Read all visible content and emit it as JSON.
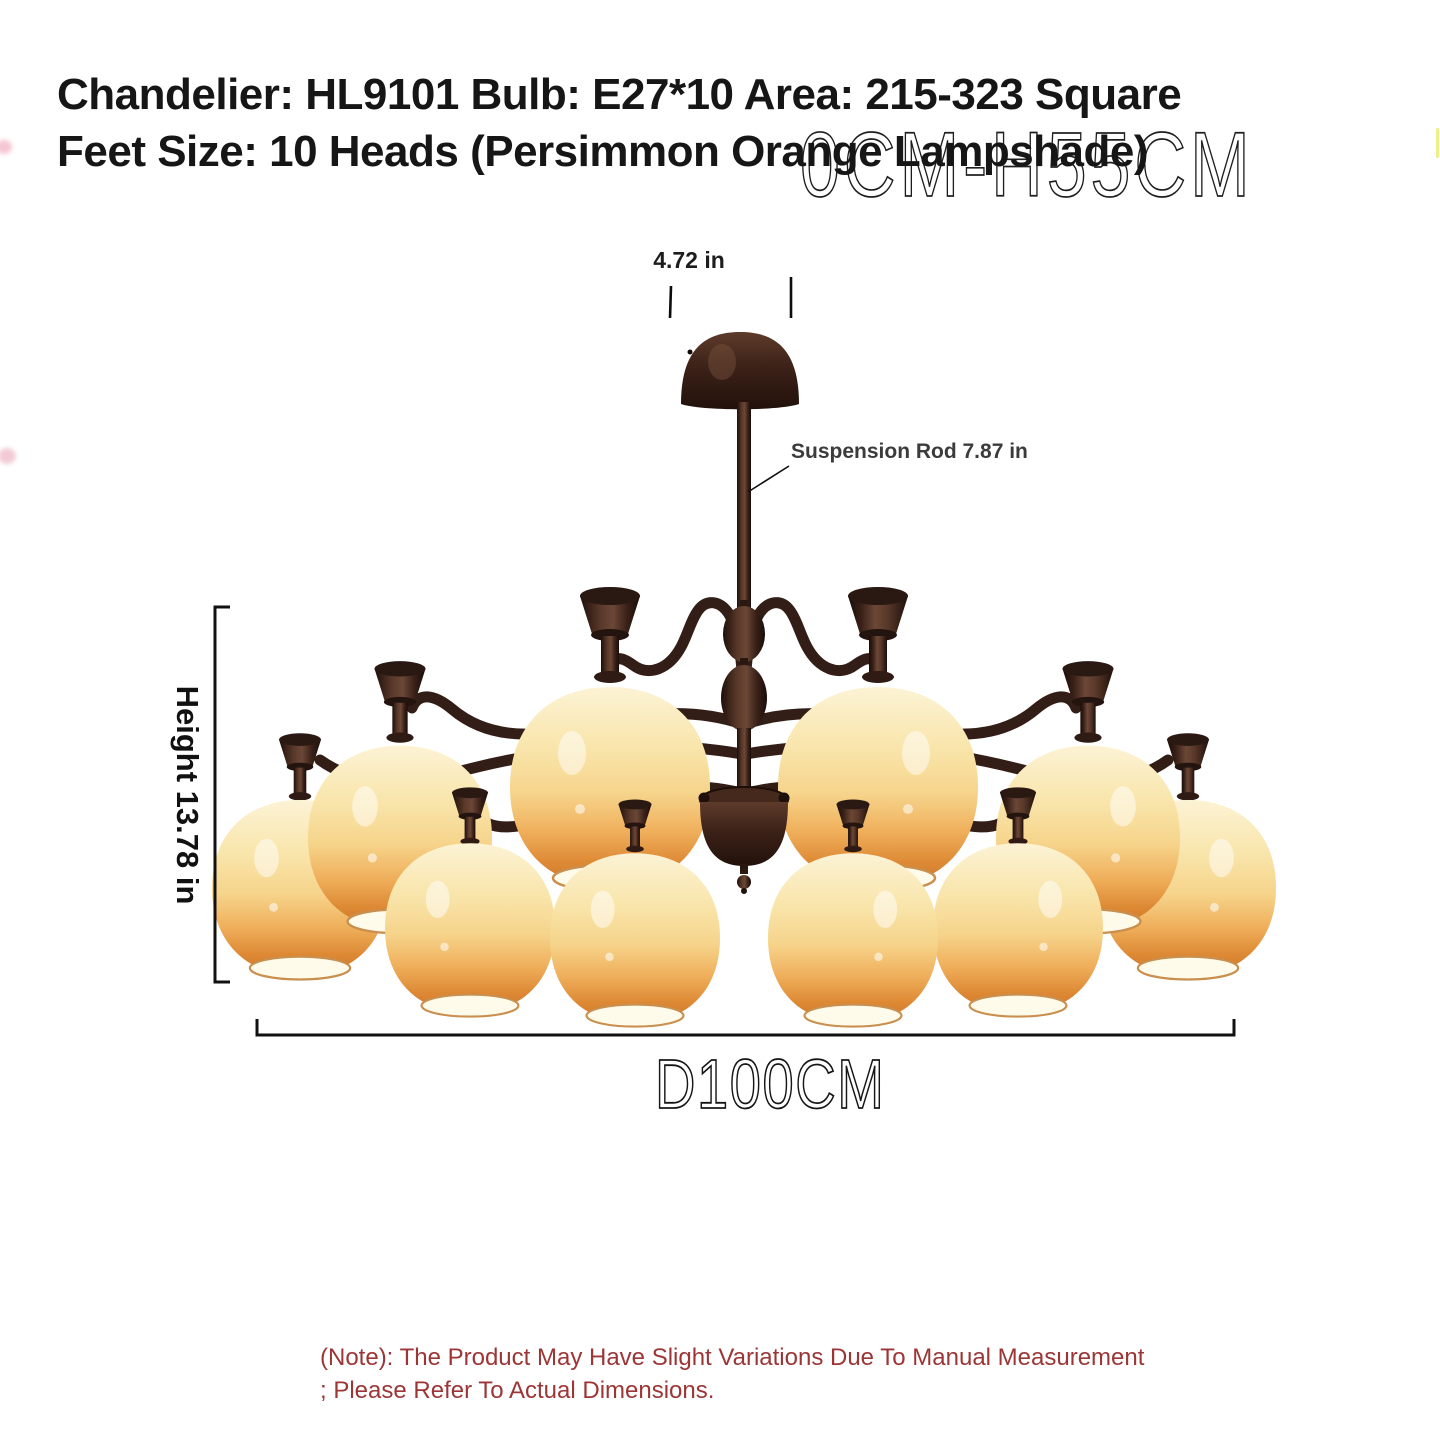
{
  "title": {
    "line1": "Chandelier: HL9101 Bulb: E27*10 Area: 215-323 Square",
    "line2": "Feet Size: 10 Heads (Persimmon Orange Lampshade)"
  },
  "background_text": "0CM-H55CM",
  "dimensions": {
    "canopy_width_label": "4.72 in",
    "suspension_rod_label": "Suspension Rod 7.87 in",
    "height_label": "Height 13.78 in",
    "diameter_label": "D100CM"
  },
  "note": {
    "line1": "(Note): The Product May Have Slight Variations Due To Manual Measurement",
    "line2": "; Please Refer To Actual Dimensions."
  },
  "product": {
    "heads": 10
  },
  "colors": {
    "title_text": "#161616",
    "note_red": "#9c3636",
    "dimension_lines": "#111111",
    "metal_dark": "#1e0f0a",
    "metal_mid": "#5a392a",
    "shade_top": "#fcf3d5",
    "shade_mid": "#f6d48b",
    "shade_bottom": "#d07a2b",
    "shade_opening": "#fffbea"
  }
}
